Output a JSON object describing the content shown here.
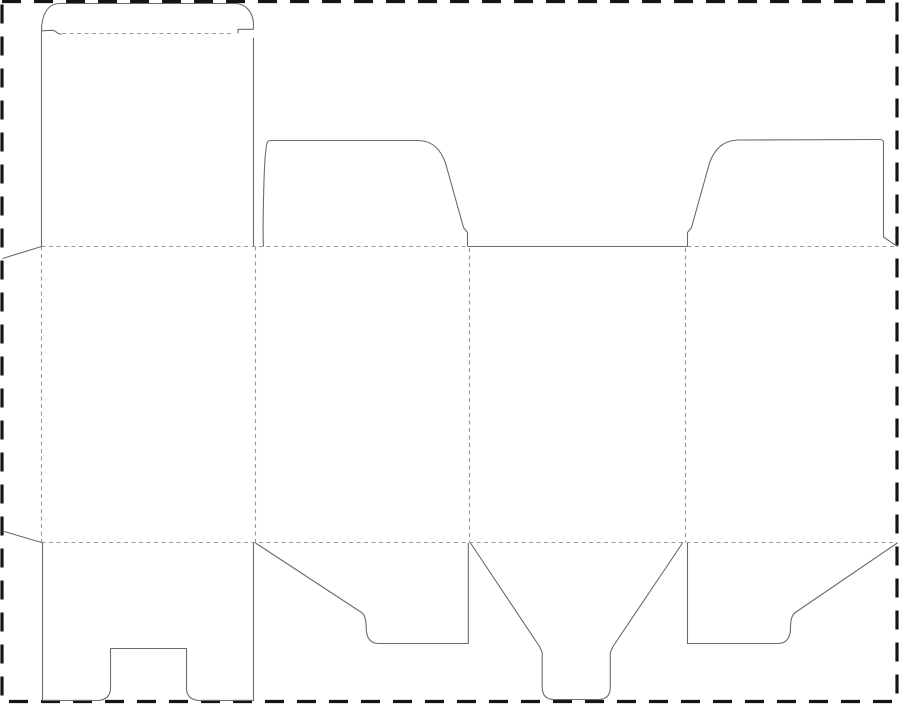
{
  "canvas": {
    "width": 900,
    "height": 705,
    "background": "#ffffff"
  },
  "styles": {
    "cut": {
      "color": "#6b6b6b",
      "width": 1.1
    },
    "fold": {
      "color": "#9a9a9a",
      "width": 1.1,
      "dash": "4 3.5"
    },
    "border": {
      "color": "#151515",
      "width": 3.2,
      "dash": "19 13"
    }
  },
  "dieline": {
    "type": "packaging-dieline",
    "page_border": {
      "name": "page-border",
      "x": 2,
      "y": 1.5,
      "width": 895,
      "height": 700
    },
    "cut_lines": [
      {
        "name": "cut-tuck-lid-outer",
        "d": "M 41.5 246.5 L 41.5 31 C 41.5 15 47.5 3.5 59.5 3.5 L 234.5 3.5 C 246.5 3.5 253.5 13 253.5 25 L 253.5 29.3"
      },
      {
        "name": "cut-tuck-lid-right-edge",
        "d": "M 253.5 37.8 L 253.5 246.5"
      },
      {
        "name": "cut-tuck-lid-slit-left",
        "d": "M 41.5 30.8 L 52.5 30.3 C 56 30.3 56.8 34.3 61.5 34.1"
      },
      {
        "name": "cut-tuck-lid-slit-right",
        "d": "M 253.5 29.3 L 238 29.3 L 238 33.4"
      },
      {
        "name": "cut-dust-flap-left",
        "d": "M 263.5 246.5 C 262.8 238 263.2 149 267.6 141.8 C 268.5 140.6 270.2 140.5 272.2 140.5 L 417.5 140.5 C 431.5 140.5 440 148 445.5 163 L 463.5 227.5 L 467.5 232.5 L 467.5 246"
      },
      {
        "name": "cut-back-panel-top-edge",
        "d": "M 467.5 246.5 L 687.5 246.5"
      },
      {
        "name": "cut-dust-flap-right",
        "d": "M 687.5 246 L 687.5 232.5 L 691.5 227.5 L 709.5 163 C 715 148 723.5 140.8 737.5 140 L 879.5 139.5 C 882.6 139.5 883.5 140.6 883.5 143.5 L 883.5 237 L 897.5 246.5"
      },
      {
        "name": "cut-glue-flap-top-diagonal",
        "d": "M 2.5 258.5 L 41.5 246.5"
      },
      {
        "name": "cut-glue-flap-bottom-diagonal",
        "d": "M 2.5 531 L 41.5 542.5"
      },
      {
        "name": "cut-bottom-flap-slotted",
        "d": "M 42.5 542.5 L 42.5 700.5 L 97 700.5 C 105.5 700.5 110.5 696 110.5 688.5 L 110.5 648.5 L 186.5 648.5 L 186.5 688.5 C 186.5 696 191.5 700.5 200 700.5 L 253.5 700.5 L 253.5 542.5"
      },
      {
        "name": "cut-bottom-flap-angled-left",
        "d": "M 255.5 543 L 361.5 612.5 C 364.8 614.8 366.2 619.5 366.2 627.5 C 366.2 637.5 370 643.5 379 643.5 L 468.3 643.5 L 468.3 543"
      },
      {
        "name": "cut-bottom-snaplock-tongue",
        "d": "M 470.5 543 L 539.5 646.5 L 542.2 652.5 L 542.2 687 C 542.2 695 546.2 699.5 554.2 699.5 L 598.3 699.5 C 606.3 699.5 610.3 695 610.3 687 L 610.3 652.5 L 613 646.5 L 682.5 543"
      },
      {
        "name": "cut-bottom-flap-angled-right",
        "d": "M 687.5 543 L 687.5 643.5 L 777.5 643.5 C 786.5 643.5 790.5 637.5 790.5 627.5 C 790.5 619.5 792 614.8 795.3 612.5 L 897.3 543"
      }
    ],
    "fold_lines": [
      {
        "name": "fold-tuck-lid-crease",
        "d": "M 62 33.5 L 233 33.5"
      },
      {
        "name": "fold-top-crease-left",
        "d": "M 41.5 246.5 L 467.5 246.5"
      },
      {
        "name": "fold-top-crease-right",
        "d": "M 687.5 246.5 L 897.5 246.5"
      },
      {
        "name": "fold-bottom-crease",
        "d": "M 41.5 542.5 L 897.5 542.5"
      },
      {
        "name": "fold-glue-flap-crease",
        "d": "M 41.5 246.5 L 41.5 542.5"
      },
      {
        "name": "fold-panel-1-2-crease",
        "d": "M 255.5 246.5 L 255.5 542.5"
      },
      {
        "name": "fold-panel-2-3-crease",
        "d": "M 469.5 248 L 469.5 542.5"
      },
      {
        "name": "fold-panel-3-4-crease",
        "d": "M 685.5 248 L 685.5 542.5"
      }
    ]
  }
}
